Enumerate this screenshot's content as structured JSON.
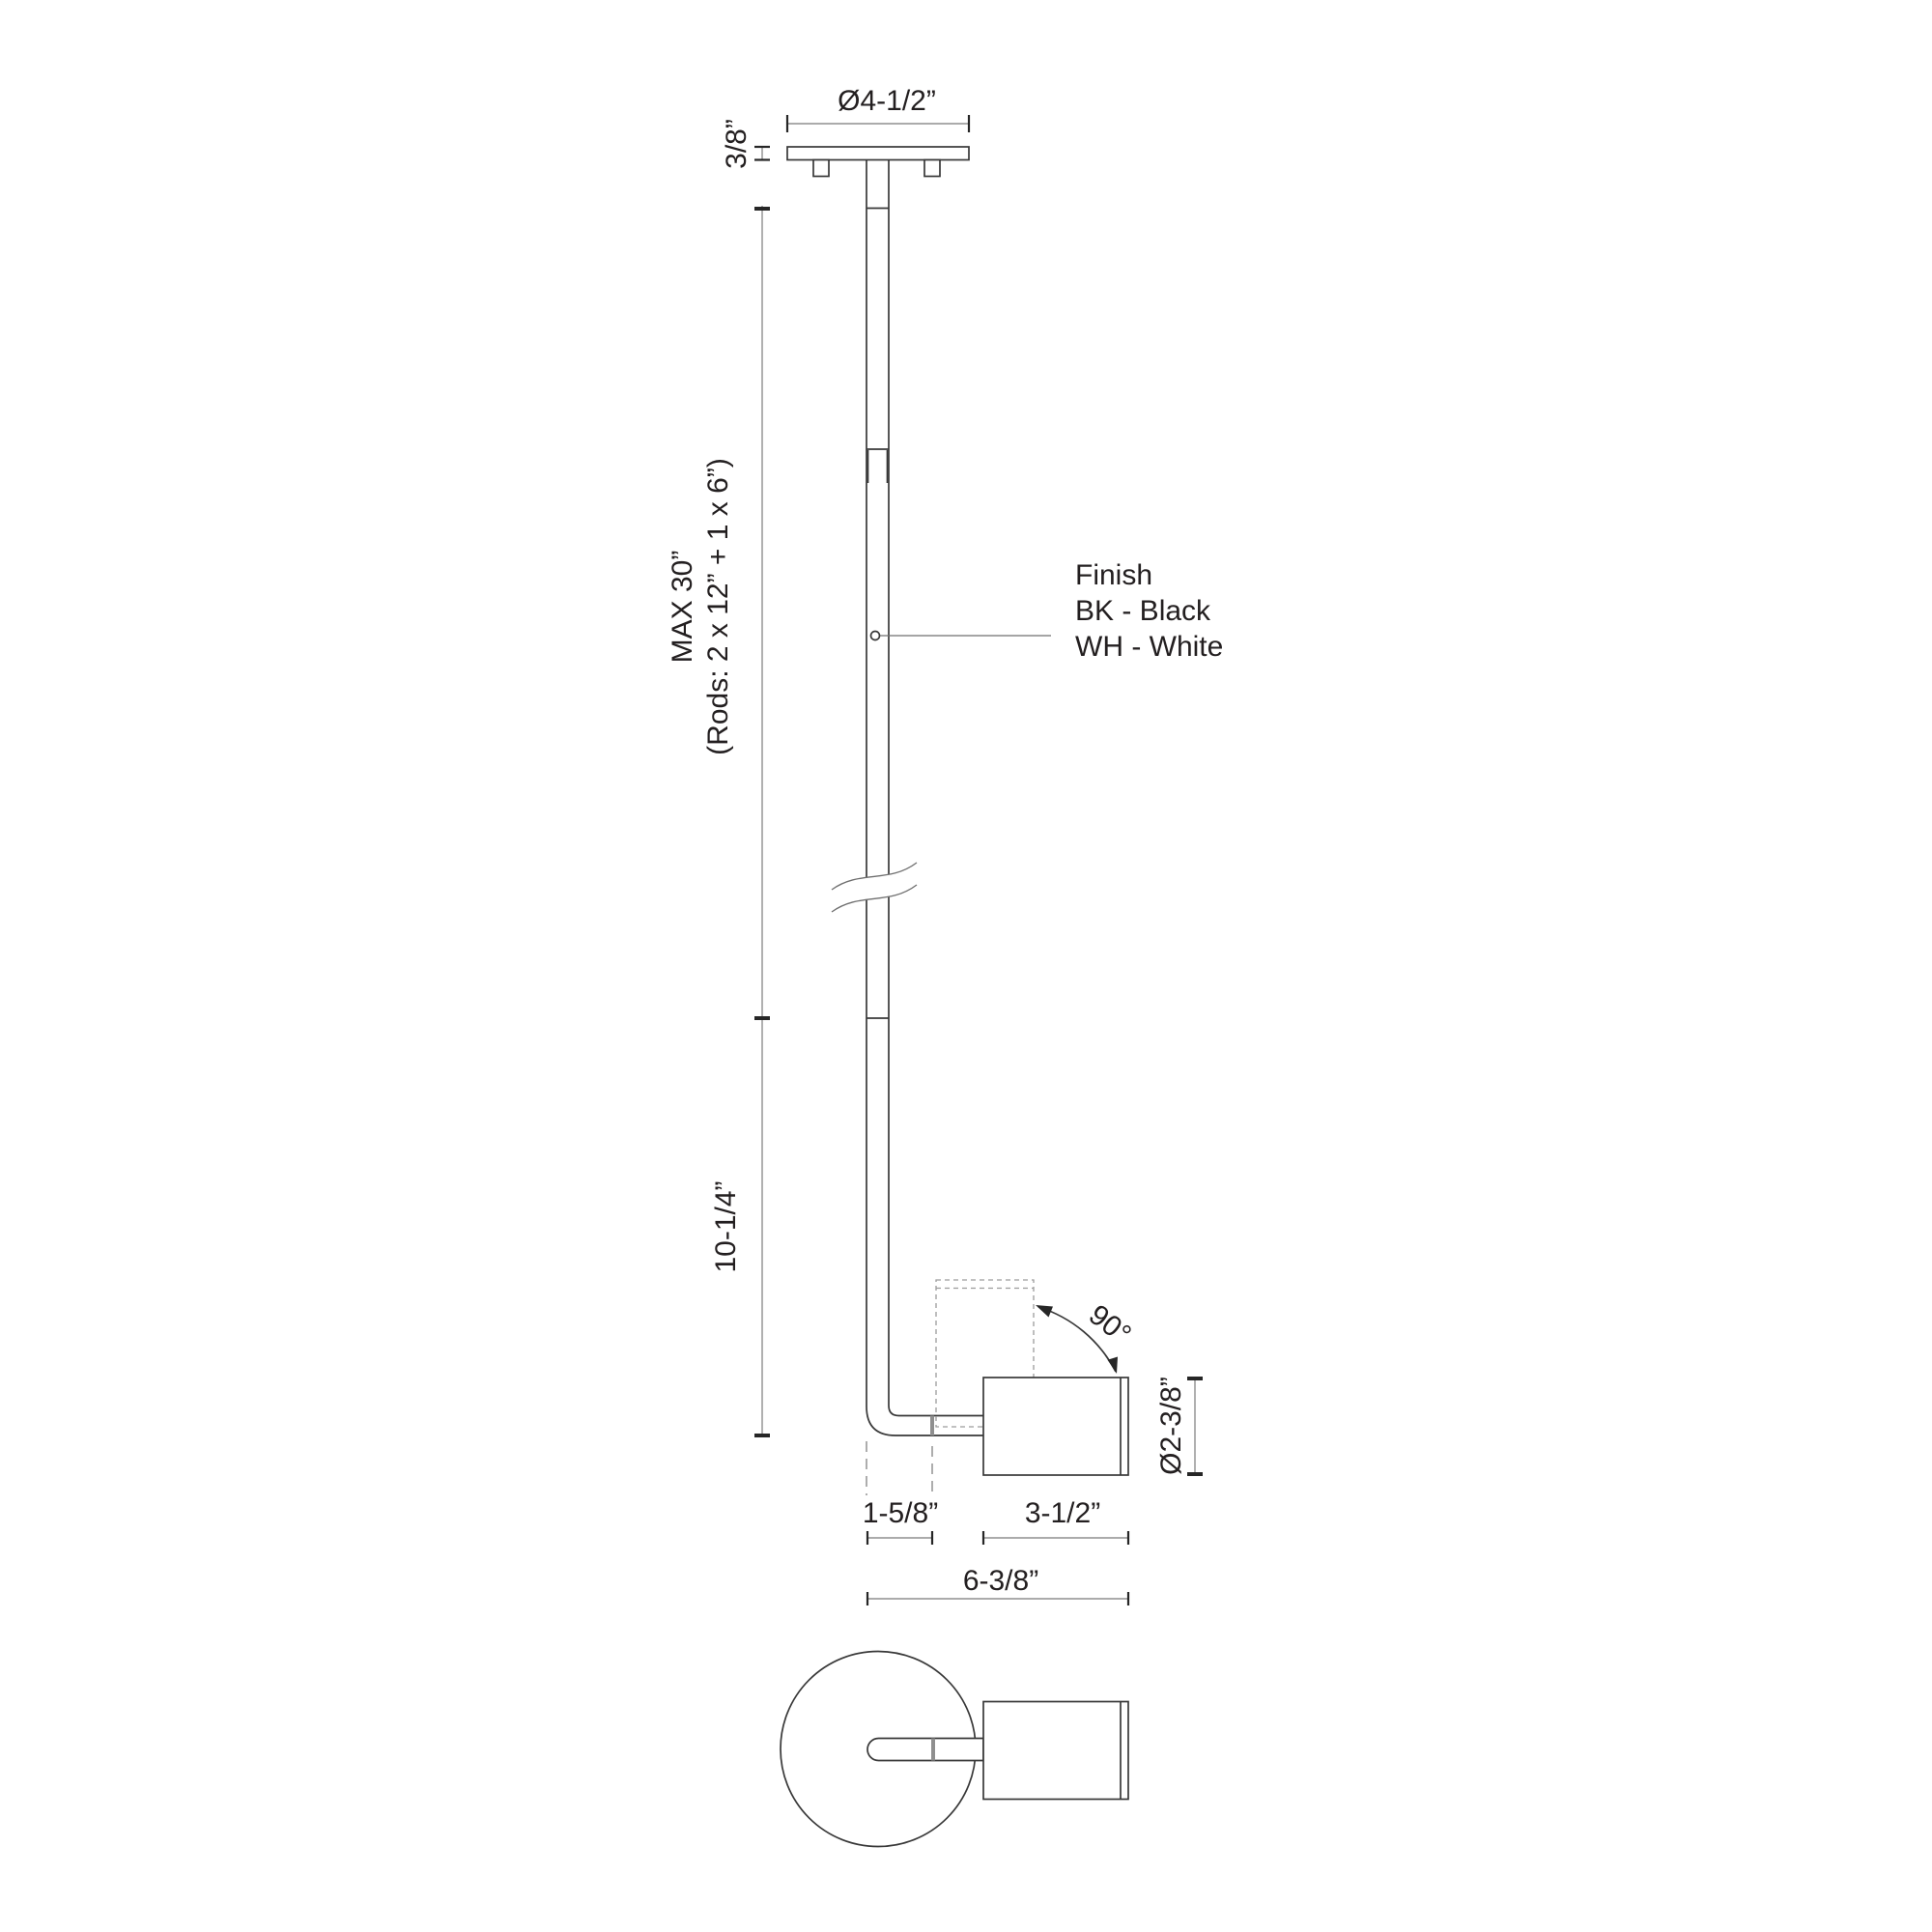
{
  "labels": {
    "canopy_diameter": "Ø4-1/2”",
    "canopy_thickness": "3/8”",
    "rod_max_length": "MAX 30”",
    "rod_note": "(Rods: 2 x 12” + 1 x 6”)",
    "finish_title": "Finish",
    "finish_black": "BK - Black",
    "finish_white": "WH - White",
    "drop_length": "10-1/4”",
    "rotation_angle": "90°",
    "head_diameter": "Ø2-3/8”",
    "head_offset": "1-5/8”",
    "head_length": "3-1/2”",
    "overall_width": "6-3/8”"
  },
  "colors": {
    "line": "#383838",
    "dimension": "#8f8f8f",
    "text": "#231f20",
    "background": "#ffffff"
  }
}
